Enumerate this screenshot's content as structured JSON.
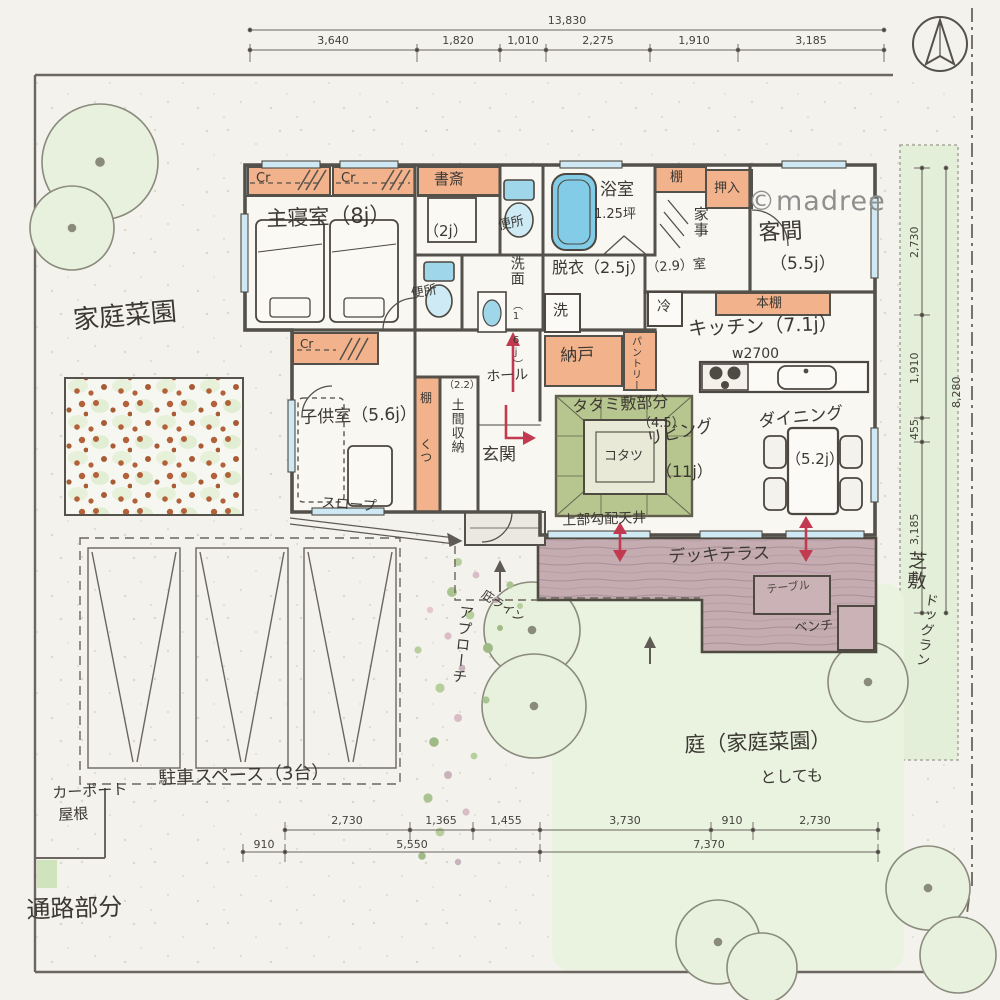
{
  "watermark": "©madree",
  "rooms": {
    "master": "主寝室（8j）",
    "cr1": "Cr",
    "cr2": "Cr",
    "cr3": "Cr",
    "study": "書斎",
    "study_size": "（2j）",
    "toilet_a": "便所",
    "toilet_b": "便所",
    "bath": "浴室",
    "bath_size": "1.25坪",
    "shelf_top": "棚",
    "oshiire": "押入",
    "guest": "客間",
    "guest_size": "（5.5j）",
    "kaji": "家事",
    "kaji_size": "（2.9）室",
    "senmen": "洗面",
    "senmen_size": "（1.6j）",
    "datsui": "脱衣（2.5j）",
    "washer": "洗",
    "nando": "納戸",
    "pantry": "パントリー",
    "fridge": "冷",
    "kitchen": "キッチン（7.1j）",
    "kitchen_width": "w2700",
    "bookshelf": "本棚",
    "tatami": "タタミ敷部分",
    "tatami_size": "（4.5）",
    "kotatsu": "コタツ",
    "living": "リビング",
    "living_size": "（11j）",
    "dining": "ダイニング",
    "dining_size": "（5.2j）",
    "hall": "ホール",
    "genkan": "玄関",
    "doma": "土間収納",
    "doma_size": "（2.2）",
    "shelf_side": "棚",
    "shoes": "くつ",
    "kids": "子供室（5.6j）",
    "slope": "スロープ",
    "deck": "デッキテラス",
    "table": "テーブル",
    "bench": "ベンチ",
    "sloped_ceiling": "上部勾配天井"
  },
  "site": {
    "garden": "家庭菜園",
    "parking": "駐車スペース（3台）",
    "carport_1": "カーポート",
    "carport_2": "屋根",
    "passage": "通路部分",
    "yard_1": "庭（家庭菜園）",
    "yard_2": "としても",
    "lawn": "芝敷",
    "dogrun": "ドッグラン",
    "approach": "アプローチ",
    "eaves": "庇ライン"
  },
  "dimensions": {
    "top": {
      "total": "13,830",
      "segments": [
        "3,640",
        "1,820",
        "1,010",
        "2,275",
        "1,910",
        "3,185"
      ]
    },
    "right": {
      "total": "8,280",
      "segments": [
        "2,730",
        "1,910",
        "455",
        "3,185"
      ]
    },
    "bottom_row1": [
      "2,730",
      "1,365",
      "1,455",
      "3,730",
      "910",
      "2,730"
    ],
    "bottom_row2": [
      "910",
      "5,550",
      "7,370"
    ]
  },
  "colors": {
    "paper": "#f3f2ec",
    "wall": "#54504a",
    "closet_orange": "#f1b28c",
    "tatami_green": "#b2c287",
    "water_blue": "#82cce8",
    "deck_wood": "#c4abb0",
    "lawn_green": "#e3efd9",
    "arrow_red": "#c23a50"
  }
}
